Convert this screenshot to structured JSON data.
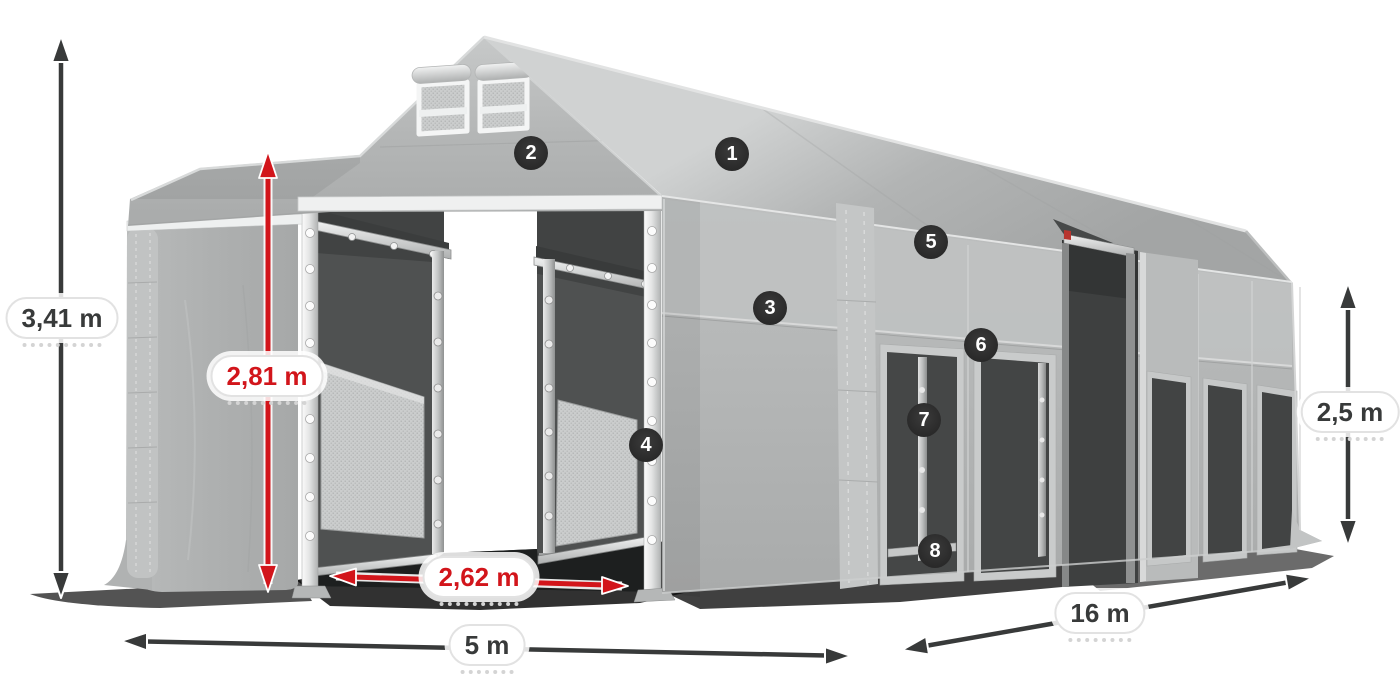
{
  "diagram": {
    "subject": "storage-tent-dimension-diagram",
    "background": "#ffffff"
  },
  "dimensions": {
    "total_height": {
      "value": "3,41 m",
      "style": "dark"
    },
    "clear_height": {
      "value": "2,81 m",
      "style": "red"
    },
    "entrance_width": {
      "value": "2,62 m",
      "style": "red"
    },
    "front_width": {
      "value": "5 m",
      "style": "dark"
    },
    "side_length": {
      "value": "16 m",
      "style": "dark"
    },
    "side_height": {
      "value": "2,5 m",
      "style": "dark"
    }
  },
  "markers": [
    {
      "number": "1"
    },
    {
      "number": "2"
    },
    {
      "number": "3"
    },
    {
      "number": "4"
    },
    {
      "number": "5"
    },
    {
      "number": "6"
    },
    {
      "number": "7"
    },
    {
      "number": "8"
    }
  ],
  "colors": {
    "dimension_red": "#d2151b",
    "dimension_dark": "#383a3a",
    "marker_background": "#2d2d2d",
    "marker_text": "#ffffff",
    "label_background": "#ffffff",
    "label_border": "#e2e2e2",
    "tent_fabric": "#b2b4b4",
    "tent_interior": "#4f5151"
  }
}
